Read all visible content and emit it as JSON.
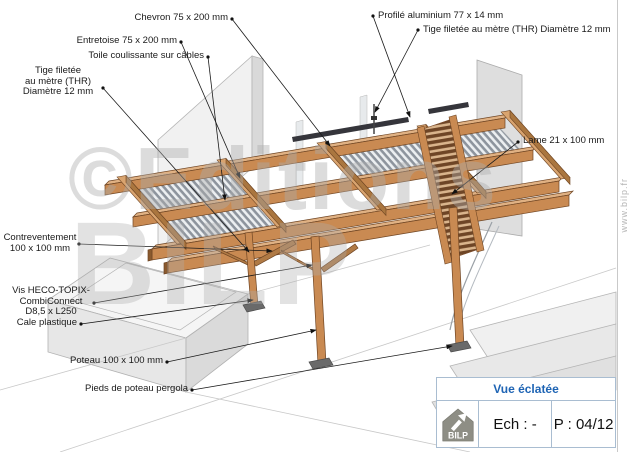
{
  "drawing": {
    "labels": {
      "chevron": "Chevron 75 x 200 mm",
      "profile_aluminium": "Profilé aluminium 77 x 14 mm",
      "entretoise": "Entretoise 75 x 200 mm",
      "toile_coulissante": "Toile coulissante sur câbles",
      "tige_filetee_left": "Tige filetée\nau mètre (THR)\nDiamètre 12 mm",
      "tige_filetee_right": "Tige filetée au mètre (THR) Diamètre 12 mm",
      "lame": "Lame 21 x 100 mm",
      "contreventement": "Contreventement\n100 x 100 mm",
      "vis": "Vis HECO-TOPIX-\nCombiConnect\nD8,5 x L250",
      "cale_plastique": "Cale plastique",
      "poteau": "Poteau 100 x 100 mm",
      "pieds_poteau": "Pieds de poteau pergola"
    },
    "watermark": {
      "line1": "©Editions",
      "line2": "BILP",
      "side_text": "www.bilp.fr"
    }
  },
  "title_block": {
    "view_title": "Vue éclatée",
    "scale_label": "Ech : -",
    "page_label": "P : 04/12",
    "logo_text": "BILP"
  },
  "colors": {
    "wood_face": "#c98a52",
    "wood_top": "#e0b183",
    "wood_dark": "#a06a34",
    "slat_gray": "#8d949d",
    "louver_brown": "#6e4526",
    "wall_gray": "#dedede",
    "title_blue": "#1e64b4",
    "block_border": "#a9bdd1",
    "watermark_gray": "#acacac"
  }
}
